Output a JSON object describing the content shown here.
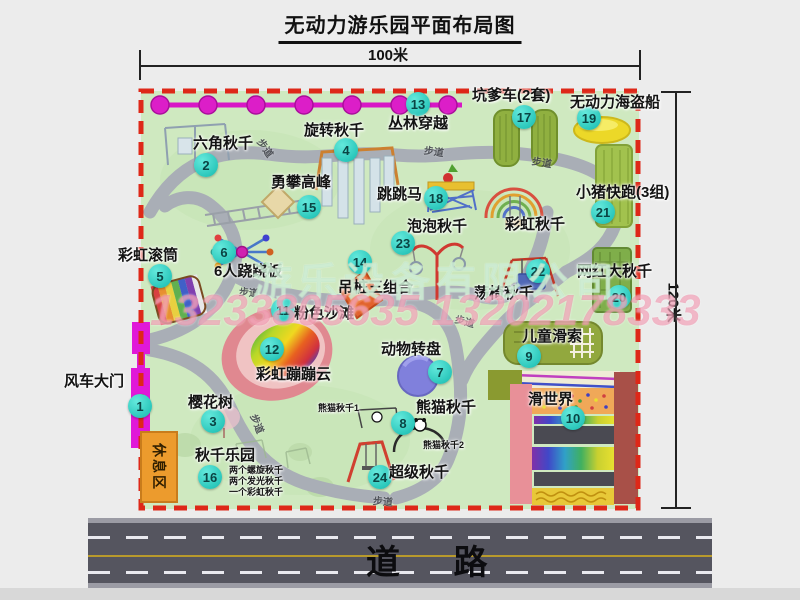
{
  "header": {
    "title": "无动力游乐园平面布局图"
  },
  "dims": {
    "top": "100米",
    "right": "120米"
  },
  "road": {
    "label": "道 路"
  },
  "watermark": {
    "company": "游乐设备有限公司",
    "phone": "13233805635 13202178333"
  },
  "colors": {
    "boundary_red": "#de2818",
    "park_green": "#cfe9c0",
    "path_gray": "#a9aeb6",
    "marker_cyan": "#2fc9bd",
    "gate_magenta": "#e018d8",
    "road_gray": "#55555f"
  },
  "map": {
    "rest_area": "休息区",
    "trail_text": "步道",
    "trail_labels": [
      {
        "x": 256,
        "y": 140,
        "rot": 55
      },
      {
        "x": 424,
        "y": 143,
        "rot": 8
      },
      {
        "x": 532,
        "y": 154,
        "rot": 10
      },
      {
        "x": 239,
        "y": 284,
        "rot": 5
      },
      {
        "x": 248,
        "y": 416,
        "rot": 68
      },
      {
        "x": 373,
        "y": 493,
        "rot": 5
      },
      {
        "x": 455,
        "y": 313,
        "rot": 15
      }
    ],
    "attractions": [
      {
        "id": "windmill-gate",
        "num": "1",
        "name": "风车大门",
        "circle": [
          140,
          406
        ],
        "label": [
          64,
          374
        ]
      },
      {
        "id": "hex-swing",
        "num": "2",
        "name": "六角秋千",
        "circle": [
          206,
          165
        ],
        "label": [
          193,
          136
        ]
      },
      {
        "id": "cherry-tree",
        "num": "3",
        "name": "樱花树",
        "circle": [
          213,
          421
        ],
        "label": [
          188,
          395
        ]
      },
      {
        "id": "rotating-swing",
        "num": "4",
        "name": "旋转秋千",
        "circle": [
          346,
          150
        ],
        "label": [
          304,
          123
        ]
      },
      {
        "id": "rainbow-roller",
        "num": "5",
        "name": "彩虹滚筒",
        "circle": [
          160,
          276
        ],
        "label": [
          118,
          248
        ]
      },
      {
        "id": "six-seesaw",
        "num": "6",
        "name": "6人跷跷板",
        "circle": [
          224,
          252
        ],
        "label": [
          214,
          264
        ]
      },
      {
        "id": "animal-turntable",
        "num": "7",
        "name": "动物转盘",
        "circle": [
          440,
          372
        ],
        "label": [
          381,
          342
        ]
      },
      {
        "id": "panda-swing",
        "num": "8",
        "name": "熊猫秋千",
        "circle": [
          403,
          423
        ],
        "label": [
          416,
          400
        ]
      },
      {
        "id": "kids-zipline",
        "num": "9",
        "name": "儿童滑索",
        "circle": [
          529,
          356
        ],
        "label": [
          522,
          329
        ]
      },
      {
        "id": "slide-world",
        "num": "10",
        "name": "滑世界",
        "circle": [
          573,
          418
        ],
        "label": [
          528,
          392
        ]
      },
      {
        "id": "pink-beach",
        "num": "11",
        "name": "粉色沙滩",
        "circle": [
          283,
          310
        ],
        "label": [
          294,
          306
        ]
      },
      {
        "id": "rainbow-cloud",
        "num": "12",
        "name": "彩虹蹦蹦云",
        "circle": [
          272,
          349
        ],
        "label": [
          256,
          367
        ]
      },
      {
        "id": "jungle-crossing",
        "num": "13",
        "name": "丛林穿越",
        "circle": [
          418,
          104
        ],
        "label": [
          388,
          116
        ]
      },
      {
        "id": "hanging-piles",
        "num": "14",
        "name": "吊桩三组合",
        "circle": [
          360,
          262
        ],
        "label": [
          338,
          280
        ]
      },
      {
        "id": "climb-peak",
        "num": "15",
        "name": "勇攀高峰",
        "circle": [
          309,
          207
        ],
        "label": [
          271,
          175
        ]
      },
      {
        "id": "swing-park",
        "num": "16",
        "name": "秋千乐园",
        "circle": [
          210,
          477
        ],
        "label": [
          195,
          448
        ]
      },
      {
        "id": "pit-cart",
        "num": "17",
        "name": "坑爹车(2套)",
        "circle": [
          524,
          117
        ],
        "label": [
          472,
          88
        ]
      },
      {
        "id": "jump-horse",
        "num": "18",
        "name": "跳跳马",
        "circle": [
          436,
          198
        ],
        "label": [
          377,
          187
        ]
      },
      {
        "id": "pirate-ship",
        "num": "19",
        "name": "无动力海盗船",
        "circle": [
          589,
          118
        ],
        "label": [
          570,
          95
        ]
      },
      {
        "id": "big-swing",
        "num": "20",
        "name": "网红大秋千",
        "circle": [
          619,
          297
        ],
        "label": [
          577,
          264
        ]
      },
      {
        "id": "piggy-run",
        "num": "21",
        "name": "小猪快跑(3组)",
        "circle": [
          603,
          212
        ],
        "label": [
          576,
          185
        ]
      },
      {
        "id": "chair-swing",
        "num": "22",
        "name": "荡椅秋千",
        "circle": [
          538,
          271
        ],
        "label": [
          474,
          286
        ]
      },
      {
        "id": "bubble-swing",
        "num": "23",
        "name": "泡泡秋千",
        "circle": [
          403,
          243
        ],
        "label": [
          407,
          219
        ]
      },
      {
        "id": "super-swing",
        "num": "24",
        "name": "超级秋千",
        "circle": [
          380,
          477
        ],
        "label": [
          389,
          465
        ]
      },
      {
        "id": "rainbow-swing",
        "num": null,
        "name": "彩虹秋千",
        "circle": null,
        "label": [
          505,
          217
        ]
      }
    ],
    "sub_labels": [
      {
        "id": "panda-swing-1",
        "text": "熊猫秋千1",
        "x": 318,
        "y": 404
      },
      {
        "id": "panda-swing-2",
        "text": "熊猫秋千2",
        "x": 423,
        "y": 441
      },
      {
        "id": "swing-park-note-1",
        "text": "两个螺旋秋千",
        "x": 229,
        "y": 466
      },
      {
        "id": "swing-park-note-2",
        "text": "两个发光秋千",
        "x": 229,
        "y": 477
      },
      {
        "id": "swing-park-note-3",
        "text": "一个彩虹秋千",
        "x": 229,
        "y": 488
      }
    ]
  }
}
